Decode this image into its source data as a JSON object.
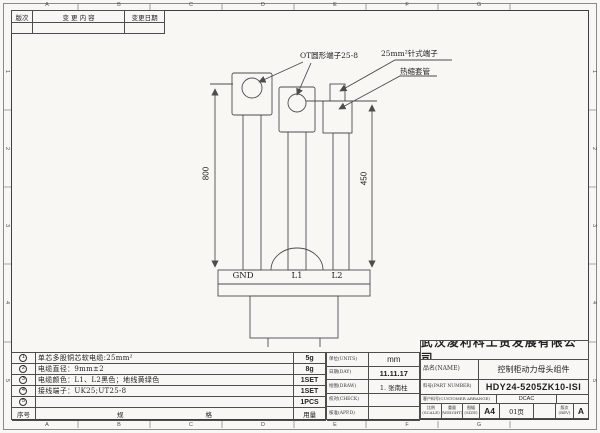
{
  "colors": {
    "paper": "#f8f7f3",
    "line": "#4d4d4d",
    "text": "#1f1f1f"
  },
  "zones": {
    "cols": [
      "A",
      "B",
      "C",
      "D",
      "E",
      "F",
      "G"
    ],
    "rows": [
      "1",
      "2",
      "3",
      "4",
      "5"
    ]
  },
  "revision_table": {
    "col_rev": "版次",
    "col_content": "变 更 内 容",
    "col_date": "变更日期"
  },
  "callouts": {
    "ot_terminal": "OT圆形端子25-8",
    "pin_terminal": "25mm²针式端子",
    "heat_shrink": "热缩套管"
  },
  "dimensions": {
    "left": "800",
    "right": "450"
  },
  "connector_labels": {
    "gnd": "GND",
    "l1": "L1",
    "l2": "L2"
  },
  "notes": {
    "rows": [
      {
        "no": "1",
        "desc": "单芯多股铜芯软电缆:25mm²",
        "qty": "5g"
      },
      {
        "no": "2",
        "desc": "电缆直径：9mm±2",
        "qty": "8g"
      },
      {
        "no": "3",
        "desc": "电缆颜色：L1、L2黑色；地线黄绿色",
        "qty": "1SET"
      },
      {
        "no": "4",
        "desc": "接线端子：UK25;UT25-8",
        "qty": "1SET"
      },
      {
        "no": "5",
        "desc": "",
        "qty": "1PCS"
      }
    ],
    "footer": {
      "col_no": "序号",
      "col_spec": "规 格",
      "col_qty": "用量"
    }
  },
  "info_block": {
    "rows": [
      {
        "label": "单位(UNITS)",
        "value": "mm"
      },
      {
        "label": "日期(DAY)",
        "value": "11.11.17"
      },
      {
        "label": "绘图(DRAW)",
        "value": "1. 张南柱"
      },
      {
        "label": "校对(CHECK)",
        "value": ""
      },
      {
        "label": "核准(APP.D)",
        "value": ""
      }
    ]
  },
  "title_block": {
    "company": "武汉凌利科工贸发展有限公司",
    "name_label": "品名(NAME)",
    "name_value": "控制柜动力母头组件",
    "part_label": "料号(PART NUMBER)",
    "part_value": "HDY24-5205ZK10-ISI",
    "customer_label": "客户料号(CUSTOMER ARRANGE)",
    "customer_value": "DCAC",
    "scale_label": "比例(SCALE)",
    "weight_label": "重量(WEIGHT)",
    "size_label": "图幅(SIZE)",
    "size_value": "A4",
    "page_value": "01页",
    "rev_label": "版次(REV)",
    "rev_value": "A"
  }
}
